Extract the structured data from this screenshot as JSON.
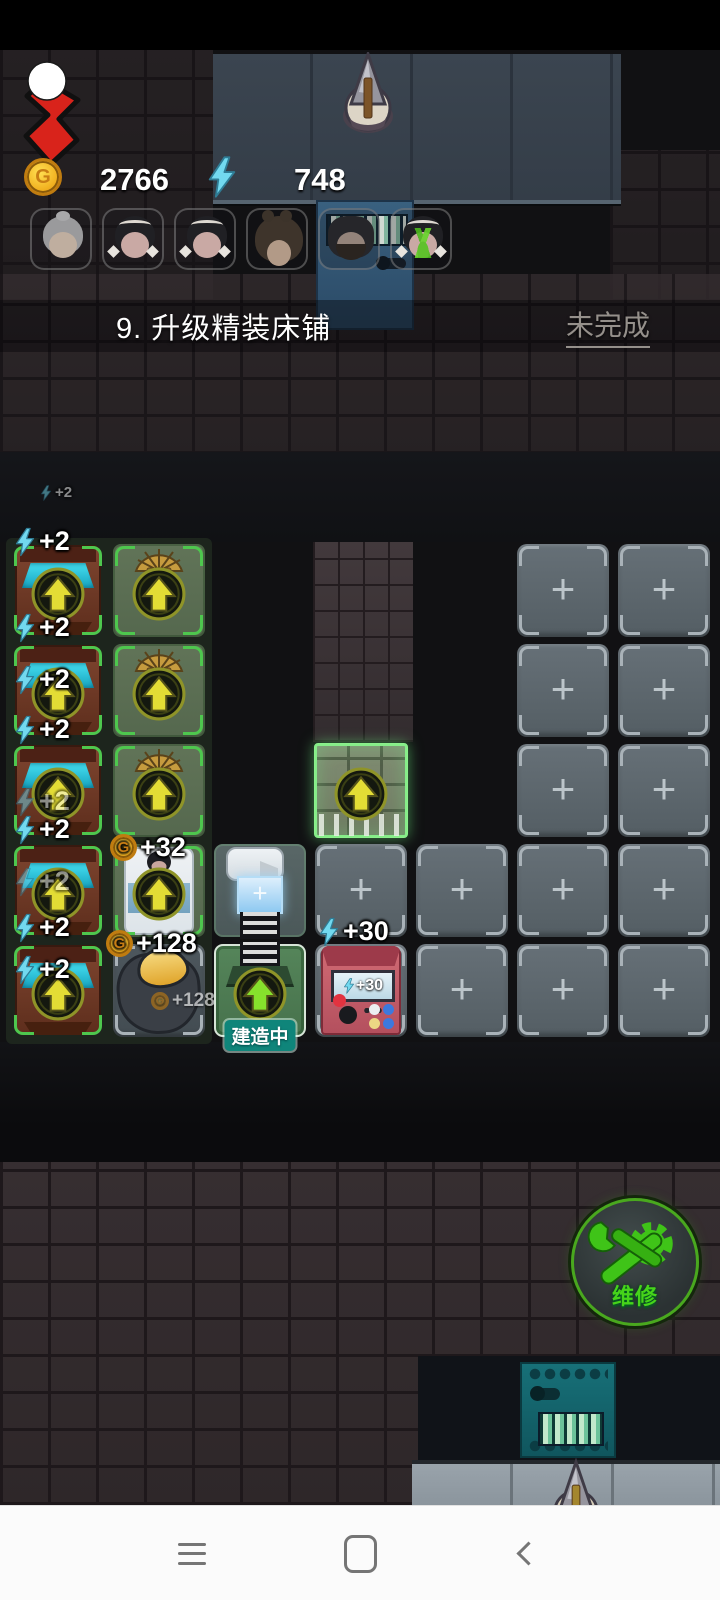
{
  "hud": {
    "coin_letter": "G",
    "coin_value": "2766",
    "energy_value": "748"
  },
  "quest": {
    "text": "9. 升级精装床铺",
    "status": "未完成"
  },
  "avatars": [
    {
      "type": "grandma"
    },
    {
      "type": "girl-bows"
    },
    {
      "type": "girl-bows"
    },
    {
      "type": "girl-buns"
    },
    {
      "type": "man-beard"
    },
    {
      "type": "girl-plant"
    }
  ],
  "grid": {
    "plus_glyph": "+",
    "tiles": [
      {
        "col": 1,
        "row": 1,
        "type": "machine"
      },
      {
        "col": 1,
        "row": 2,
        "type": "machine"
      },
      {
        "col": 1,
        "row": 3,
        "type": "machine"
      },
      {
        "col": 1,
        "row": 4,
        "type": "machine"
      },
      {
        "col": 1,
        "row": 5,
        "type": "machine"
      },
      {
        "col": 2,
        "row": 1,
        "type": "bunk"
      },
      {
        "col": 2,
        "row": 2,
        "type": "bunk"
      },
      {
        "col": 2,
        "row": 3,
        "type": "bunk"
      },
      {
        "col": 2,
        "row": 4,
        "type": "bed"
      },
      {
        "col": 2,
        "row": 5,
        "type": "ore",
        "label": "+128"
      },
      {
        "col": 3,
        "row": 4,
        "type": "drill-top"
      },
      {
        "col": 3,
        "row": 5,
        "type": "drill-build",
        "label": "建造中"
      },
      {
        "col": 4,
        "row": 3,
        "type": "gate"
      },
      {
        "col": 4,
        "row": 4,
        "type": "plus"
      },
      {
        "col": 4,
        "row": 5,
        "type": "arcade",
        "screen": "+30"
      },
      {
        "col": 5,
        "row": 4,
        "type": "plus"
      },
      {
        "col": 5,
        "row": 5,
        "type": "plus"
      },
      {
        "col": 6,
        "row": 1,
        "type": "plus"
      },
      {
        "col": 6,
        "row": 2,
        "type": "plus"
      },
      {
        "col": 6,
        "row": 3,
        "type": "plus"
      },
      {
        "col": 6,
        "row": 4,
        "type": "plus"
      },
      {
        "col": 6,
        "row": 5,
        "type": "plus"
      },
      {
        "col": 7,
        "row": 1,
        "type": "plus"
      },
      {
        "col": 7,
        "row": 2,
        "type": "plus"
      },
      {
        "col": 7,
        "row": 3,
        "type": "plus"
      },
      {
        "col": 7,
        "row": 4,
        "type": "plus"
      },
      {
        "col": 7,
        "row": 5,
        "type": "plus"
      }
    ],
    "labels": [
      {
        "x": 40,
        "y": 434,
        "kind": "energy",
        "text": "+2",
        "cls": "tiny"
      },
      {
        "x": 14,
        "y": 476,
        "kind": "energy",
        "text": "+2"
      },
      {
        "x": 14,
        "y": 562,
        "kind": "energy",
        "text": "+2"
      },
      {
        "x": 14,
        "y": 614,
        "kind": "energy",
        "text": "+2"
      },
      {
        "x": 14,
        "y": 664,
        "kind": "energy",
        "text": "+2"
      },
      {
        "x": 14,
        "y": 736,
        "kind": "energy",
        "text": "+2",
        "cls": "faded"
      },
      {
        "x": 14,
        "y": 764,
        "kind": "energy",
        "text": "+2"
      },
      {
        "x": 14,
        "y": 816,
        "kind": "energy",
        "text": "+2",
        "cls": "faded"
      },
      {
        "x": 14,
        "y": 862,
        "kind": "energy",
        "text": "+2"
      },
      {
        "x": 14,
        "y": 904,
        "kind": "energy",
        "text": "+2"
      },
      {
        "x": 110,
        "y": 782,
        "kind": "coin",
        "text": "+32"
      },
      {
        "x": 106,
        "y": 878,
        "kind": "coin",
        "text": "+128"
      },
      {
        "x": 318,
        "y": 866,
        "kind": "energy",
        "text": "+30"
      }
    ]
  },
  "repair_button": {
    "label": "维修"
  },
  "nav": {
    "items": [
      {
        "name": "menu"
      },
      {
        "name": "home"
      },
      {
        "name": "back"
      }
    ]
  }
}
